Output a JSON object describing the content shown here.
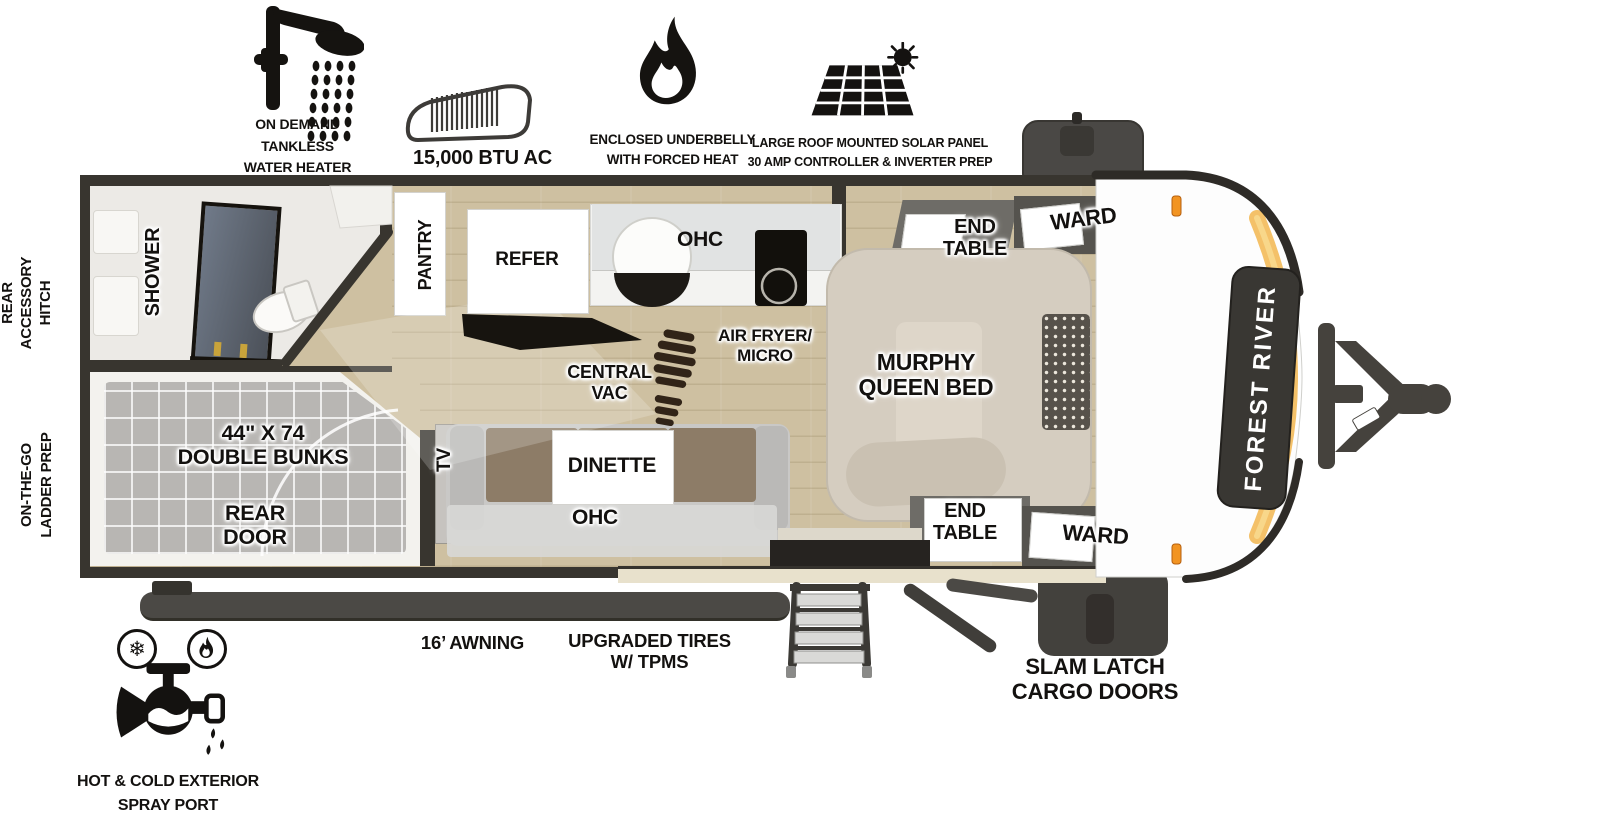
{
  "brand": "FOREST RIVER",
  "top_features": {
    "water_heater": {
      "icon": "shower-head-icon",
      "label": "ON DEMAND\nTANKLESS\nWATER HEATER"
    },
    "ac": {
      "icon": "ac-unit-icon",
      "label": "15,000 BTU AC"
    },
    "underbelly": {
      "icon": "flame-icon",
      "label": "ENCLOSED UNDERBELLY\nWITH FORCED HEAT"
    },
    "solar": {
      "icon": "solar-panel-icon",
      "label": "LARGE ROOF MOUNTED SOLAR PANEL\n30 AMP CONTROLLER & INVERTER PREP"
    }
  },
  "side_labels": {
    "rear_accessory_hitch": "REAR\nACCESSORY\nHITCH",
    "on_the_go_ladder_prep": "ON-THE-GO\nLADDER PREP"
  },
  "interior": {
    "shower": "SHOWER",
    "pantry": "PANTRY",
    "refer": "REFER",
    "kitchen_ohc": "OHC",
    "air_fryer_micro": "AIR FRYER/\nMICRO",
    "central_vac": "CENTRAL\nVAC",
    "murphy_bed": "MURPHY\nQUEEN BED",
    "end_table_top": "END\nTABLE",
    "ward_top": "WARD",
    "end_table_bottom": "END\nTABLE",
    "ward_bottom": "WARD",
    "double_bunks": "44\" X 74\nDOUBLE BUNKS",
    "rear_door": "REAR\nDOOR",
    "tv": "TV",
    "dinette": "DINETTE",
    "dinette_ohc": "OHC"
  },
  "exterior": {
    "awning": "16’ AWNING",
    "tires": "UPGRADED TIRES\nW/ TPMS",
    "cargo_doors": "SLAM LATCH\nCARGO DOORS",
    "spray_port": "HOT & COLD EXTERIOR\nSPRAY PORT"
  },
  "colors": {
    "wall": "#38352f",
    "floor": "#cec0a1",
    "accent_gold": "#f2b64f",
    "marker_light": "#f29422"
  }
}
